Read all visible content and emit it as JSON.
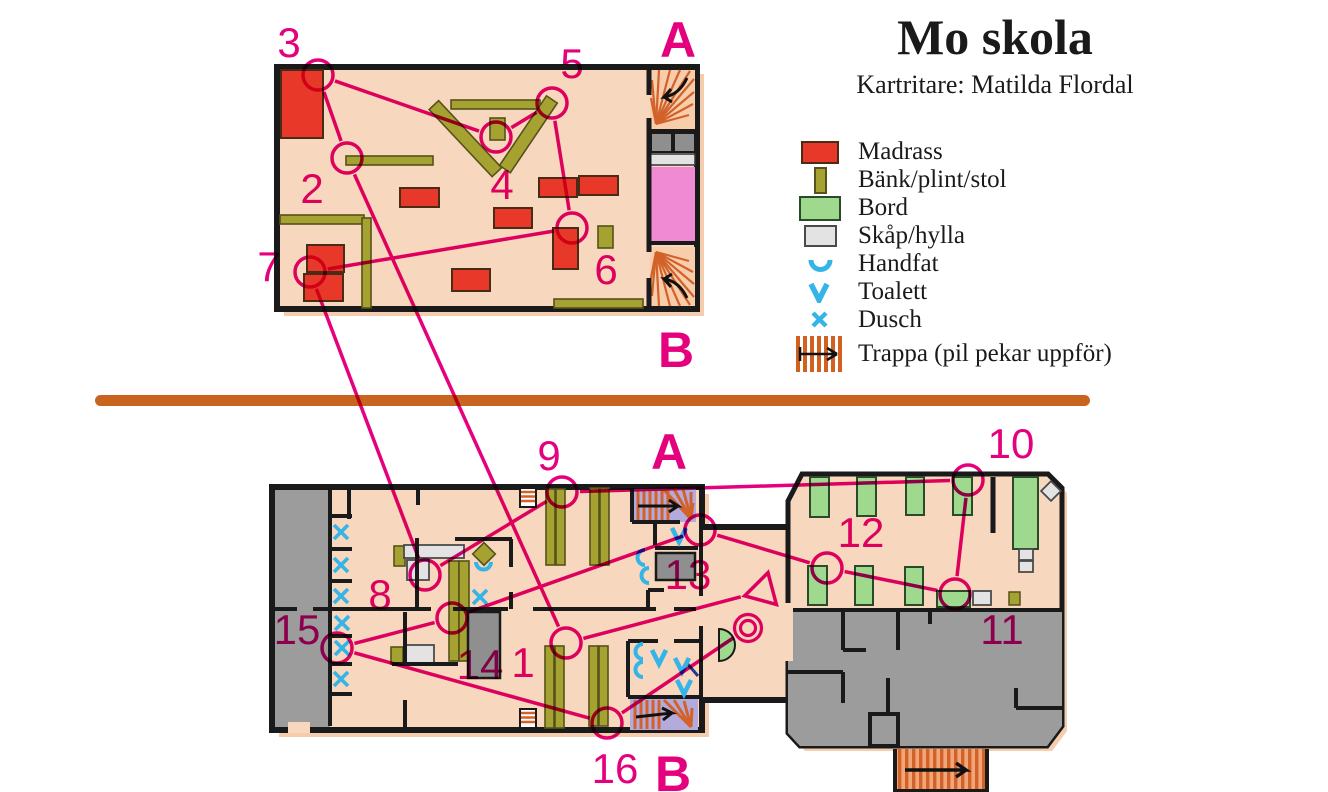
{
  "header": {
    "title": "Mo skola",
    "subtitle": "Kartritare: Matilda Flordal"
  },
  "legend": {
    "items": [
      {
        "key": "madrass",
        "label": "Madrass",
        "color": "#e8382a"
      },
      {
        "key": "bank",
        "label": "Bänk/plint/stol",
        "color": "#a6a232"
      },
      {
        "key": "bord",
        "label": "Bord",
        "color": "#9ed98e"
      },
      {
        "key": "skap",
        "label": "Skåp/hylla",
        "color": "#e3e3e3"
      },
      {
        "key": "handfat",
        "label": "Handfat",
        "color": "#35b4e8"
      },
      {
        "key": "toalett",
        "label": "Toalett",
        "color": "#35b4e8"
      },
      {
        "key": "dusch",
        "label": "Dusch",
        "color": "#35b4e8"
      },
      {
        "key": "trappa",
        "label": "Trappa (pil pekar uppför)",
        "color": "#d2611f"
      }
    ]
  },
  "palette": {
    "course": "#e5017d",
    "floor": "#f7d7bd",
    "wall": "#1a1a1a",
    "out_of_bounds": "#9c9c9c",
    "water": "#35b4e8",
    "stair_orange": "#d2622a",
    "stair_purple": "#b4abdd",
    "divider": "#c8641f",
    "lift_pink": "#f08ad2"
  },
  "course": {
    "color": "#e5017d",
    "circle_radius": 15,
    "start": {
      "x": 763,
      "y": 591
    },
    "finish": {
      "x": 748,
      "y": 628
    },
    "controls": [
      {
        "n": "1",
        "x": 566,
        "y": 643,
        "lx": 523,
        "ly": 677
      },
      {
        "n": "2",
        "x": 347,
        "y": 158,
        "lx": 312,
        "ly": 203
      },
      {
        "n": "3",
        "x": 318,
        "y": 75,
        "lx": 289,
        "ly": 57
      },
      {
        "n": "4",
        "x": 496,
        "y": 137,
        "lx": 502,
        "ly": 199
      },
      {
        "n": "5",
        "x": 552,
        "y": 103,
        "lx": 572,
        "ly": 78
      },
      {
        "n": "6",
        "x": 572,
        "y": 228,
        "lx": 606,
        "ly": 284
      },
      {
        "n": "7",
        "x": 310,
        "y": 272,
        "lx": 269,
        "ly": 281
      },
      {
        "n": "8",
        "x": 425,
        "y": 575,
        "lx": 380,
        "ly": 609
      },
      {
        "n": "9",
        "x": 562,
        "y": 492,
        "lx": 549,
        "ly": 470
      },
      {
        "n": "10",
        "x": 968,
        "y": 480,
        "lx": 1011,
        "ly": 458
      },
      {
        "n": "11",
        "x": 955,
        "y": 594,
        "lx": 1002,
        "ly": 644
      },
      {
        "n": "12",
        "x": 827,
        "y": 568,
        "lx": 861,
        "ly": 547
      },
      {
        "n": "13",
        "x": 700,
        "y": 530,
        "lx": 688,
        "ly": 589
      },
      {
        "n": "14",
        "x": 452,
        "y": 618,
        "lx": 480,
        "ly": 679
      },
      {
        "n": "15",
        "x": 337,
        "y": 648,
        "lx": 297,
        "ly": 644
      },
      {
        "n": "16",
        "x": 607,
        "y": 723,
        "lx": 615,
        "ly": 783
      }
    ],
    "stair_letters": [
      {
        "t": "A",
        "x": 678,
        "y": 57
      },
      {
        "t": "B",
        "x": 676,
        "y": 367
      },
      {
        "t": "A",
        "x": 669,
        "y": 469
      },
      {
        "t": "B",
        "x": 673,
        "y": 791
      }
    ]
  }
}
